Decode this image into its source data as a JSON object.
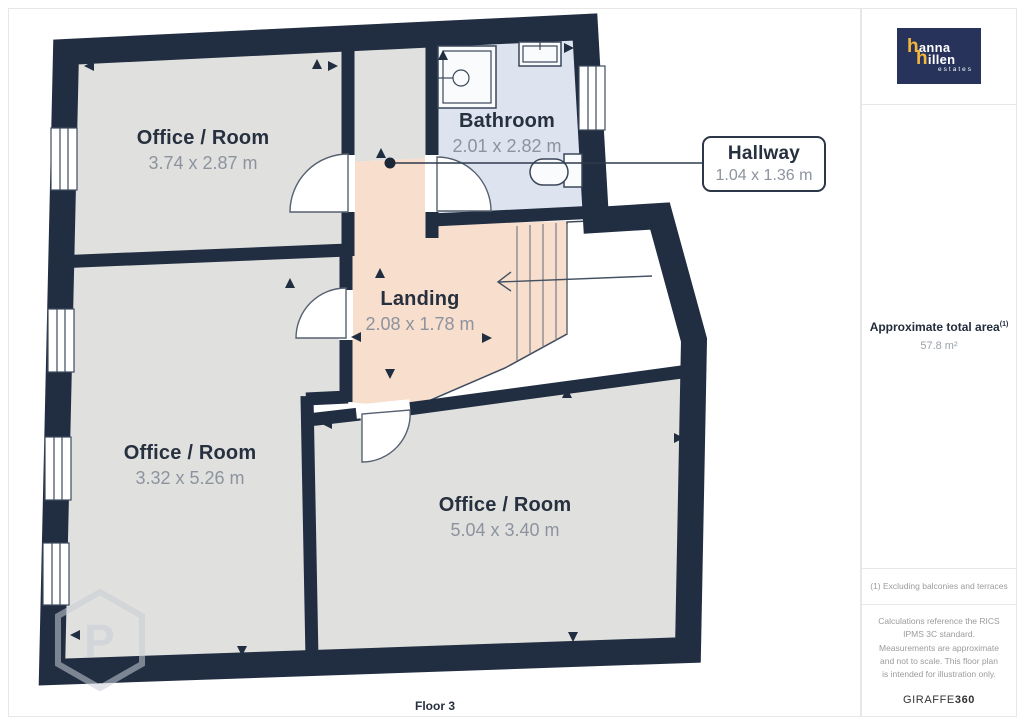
{
  "plan": {
    "floor_label": "Floor 3",
    "watermark_letter": "P",
    "rooms": [
      {
        "key": "office_top_left",
        "name": "Office / Room",
        "dims": "3.74 x 2.87 m"
      },
      {
        "key": "bathroom",
        "name": "Bathroom",
        "dims": "2.01 x 2.82 m"
      },
      {
        "key": "hallway",
        "name": "Hallway",
        "dims": "1.04 x 1.36 m"
      },
      {
        "key": "landing",
        "name": "Landing",
        "dims": "2.08 x 1.78 m"
      },
      {
        "key": "office_bottom_left",
        "name": "Office / Room",
        "dims": "3.32 x 5.26 m"
      },
      {
        "key": "office_bottom_right",
        "name": "Office / Room",
        "dims": "5.04 x 3.40 m"
      }
    ]
  },
  "sidebar": {
    "logo": {
      "line1_accent": "h",
      "line1_rest": "anna",
      "line2_accent": "h",
      "line2_rest": "illen",
      "tagline": "estates"
    },
    "area_title": "Approximate total area",
    "area_footnote_ref": "(1)",
    "area_value": "57.8 m²",
    "footnote": "(1) Excluding balconies and terraces",
    "disclaimer": "Calculations reference the RICS IPMS 3C standard. Measurements are approximate and not to scale. This floor plan is intended for illustration only.",
    "brand_regular": "GIRAFFE",
    "brand_bold": "360"
  },
  "colors": {
    "wall": "#212d40",
    "room-gray": "#e0e0de",
    "peach": "#f7decd",
    "bath-blue": "#dde4ef",
    "ink": "#27303f",
    "dims": "#8d939e",
    "thin-line": "#3e4b5e",
    "logo-navy": "#28335c",
    "logo-yellow": "#f2b63c",
    "watermark": "#c9ced6",
    "panel-border": "#e7e7e7"
  }
}
